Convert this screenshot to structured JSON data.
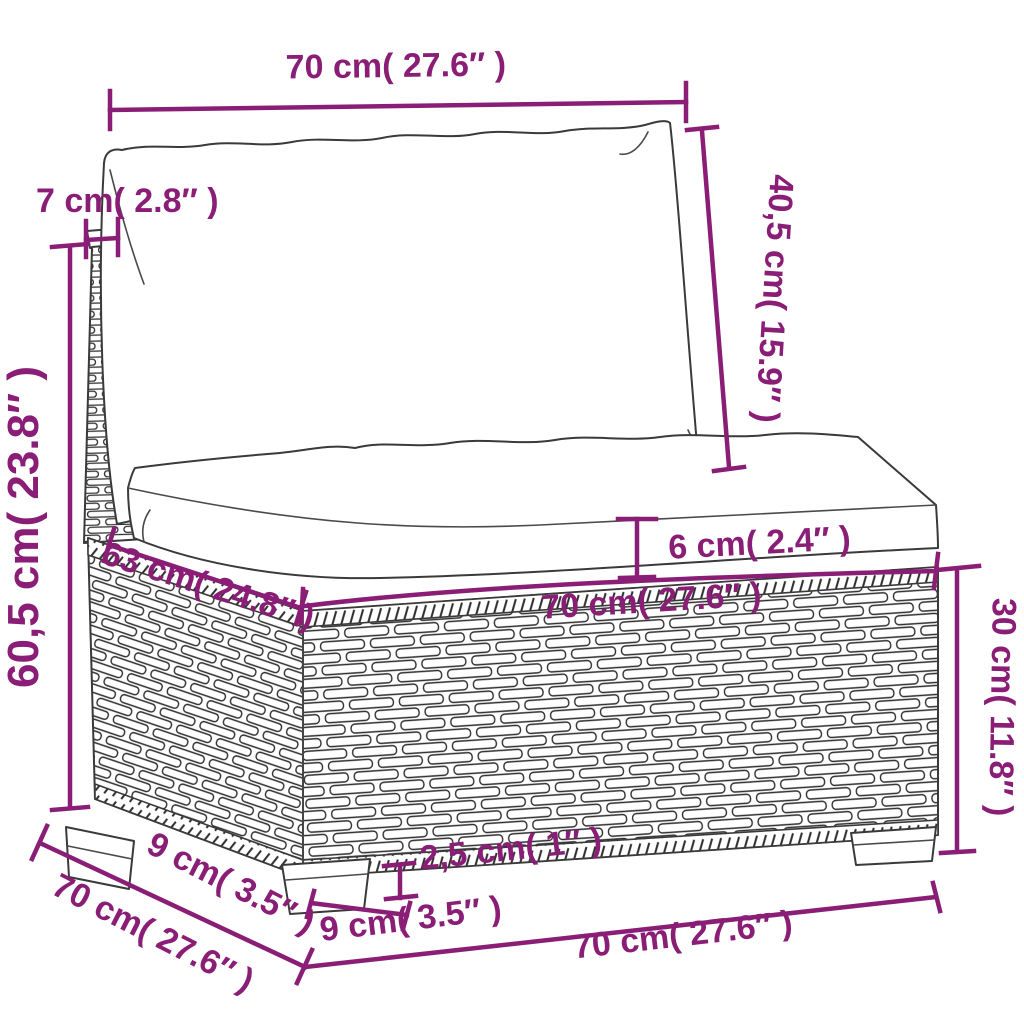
{
  "diagram": {
    "colors": {
      "accent": "#8a1e76",
      "outline": "#3a3a3a",
      "background": "#ffffff"
    },
    "dimensions": [
      {
        "id": "top-width",
        "label": "70 cm( 27.6″ )"
      },
      {
        "id": "back-post-width",
        "label": "7 cm( 2.8″ )"
      },
      {
        "id": "backrest-height",
        "label": "40,5 cm( 15.9″ )"
      },
      {
        "id": "total-height",
        "label": "60,5 cm( 23.8″ )"
      },
      {
        "id": "seat-cushion-thickness",
        "label": "6 cm( 2.4″ )"
      },
      {
        "id": "seat-depth",
        "label": "63 cm( 24.8″ )"
      },
      {
        "id": "seat-front-width",
        "label": "70 cm( 27.6″ )"
      },
      {
        "id": "base-height",
        "label": "30 cm( 11.8″ )"
      },
      {
        "id": "plinth-height",
        "label": "2,5 cm( 1″ )"
      },
      {
        "id": "foot-depth",
        "label": "9 cm( 3.5″ )"
      },
      {
        "id": "base-depth",
        "label": "70 cm( 27.6″ )"
      },
      {
        "id": "foot-width",
        "label": "9 cm( 3.5″ )"
      },
      {
        "id": "bottom-front-width",
        "label": "70 cm( 27.6″ )"
      }
    ]
  }
}
